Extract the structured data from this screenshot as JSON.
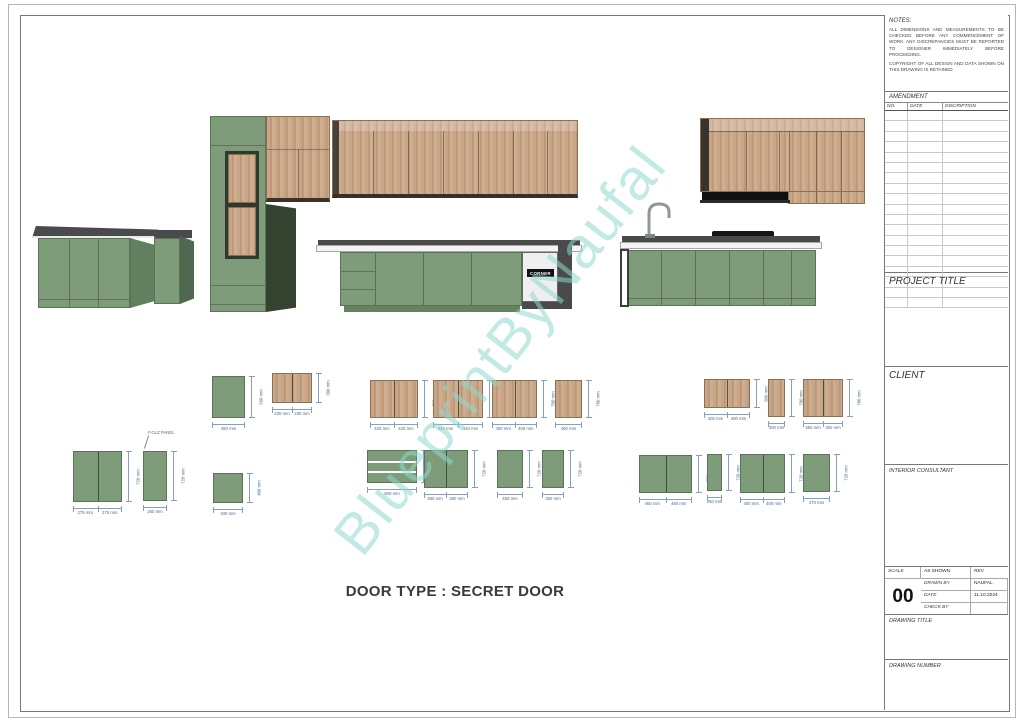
{
  "sheet": {
    "watermark": "BlueprintByNaufal",
    "caption": "DOOR TYPE : SECRET DOOR",
    "corner_label": "CORNER"
  },
  "titleblock": {
    "notes": {
      "label": "NOTES:",
      "para1": "ALL DIMENSIONS AND MEASUREMENTS TO BE CHECKED BEFORE ANY COMMENCEMENT OF WORK. ANY DISCREPANCIES MUST BE REPORTED TO DESIGNER IMMEDIATELY BEFORE PROCEEDING.",
      "para2": "COPYRIGHT OF ALL DESIGN AND DATA SHOWN ON THIS DRAWING IS RETAINED"
    },
    "amendment": {
      "label": "AMENDMENT",
      "columns": [
        "NO.",
        "DATE",
        "DISCRIPTION"
      ],
      "rows": 19
    },
    "project_title_label": "PROJECT TITLE",
    "client_label": "CLIENT",
    "interior_consultant_label": "INTERIOR CONSULTANT",
    "scale_label": "SCALE",
    "scale_value": "AS SHOWN",
    "drawn_by_label": "DRAWN BY",
    "drawn_by_value": "NAUFAL",
    "date_label": "DATE",
    "date_value": "11.10.2024",
    "check_by_label": "CHECK BY",
    "check_by_value": "",
    "rev_label": "REV",
    "rev_value": "00",
    "drawing_title_label": "DRAWING TITLE",
    "drawing_number_label": "DRAWING NUMBER"
  },
  "colors": {
    "cabinet_green": "#7e9c79",
    "cabinet_green_dark": "#62805f",
    "wood": "#c9a587",
    "counter_edge": "#4a4a4a",
    "watermark": "#8ed8ce",
    "dimension": "#85a0bc"
  },
  "details": {
    "annotation": "F.GLZ PANEL",
    "panels": [
      {
        "id": "L1",
        "x": 73,
        "y": 451,
        "w": 49,
        "h": 51,
        "mat": "green",
        "doors": 2,
        "dw": [
          "275 mm",
          "275 mm"
        ],
        "dh": "720 mm"
      },
      {
        "id": "L2",
        "x": 143,
        "y": 451,
        "w": 24,
        "h": 50,
        "mat": "green",
        "doors": 1,
        "dw": [
          "260 mm"
        ],
        "dh": "720 mm"
      },
      {
        "id": "L3",
        "x": 212,
        "y": 376,
        "w": 33,
        "h": 42,
        "mat": "green",
        "doors": 1,
        "dw": [
          "450 mm"
        ],
        "dh": "560 mm"
      },
      {
        "id": "L4",
        "x": 272,
        "y": 373,
        "w": 40,
        "h": 30,
        "mat": "wood",
        "doors": 2,
        "dw": [
          "230 mm",
          "230 mm"
        ],
        "dh": "380 mm"
      },
      {
        "id": "L5",
        "x": 213,
        "y": 473,
        "w": 30,
        "h": 30,
        "mat": "green",
        "doors": 1,
        "dw": [
          "400 mm"
        ],
        "dh": "400 mm"
      },
      {
        "id": "M1",
        "x": 370,
        "y": 380,
        "w": 48,
        "h": 38,
        "mat": "wood",
        "doors": 2,
        "dw": [
          "420 mm",
          "420 mm"
        ],
        "dh": "780 mm"
      },
      {
        "id": "M2",
        "x": 433,
        "y": 380,
        "w": 50,
        "h": 38,
        "mat": "wood",
        "doors": 2,
        "dw": [
          "440 mm",
          "440 mm"
        ],
        "dh": "780 mm"
      },
      {
        "id": "M3",
        "x": 492,
        "y": 380,
        "w": 45,
        "h": 38,
        "mat": "wood",
        "doors": 2,
        "dw": [
          "400 mm",
          "400 mm"
        ],
        "dh": "780 mm"
      },
      {
        "id": "M4",
        "x": 555,
        "y": 380,
        "w": 27,
        "h": 38,
        "mat": "wood",
        "doors": 1,
        "dw": [
          "460 mm"
        ],
        "dh": "780 mm"
      },
      {
        "id": "M5",
        "x": 367,
        "y": 450,
        "w": 50,
        "h": 33,
        "mat": "drawers",
        "doors": 1,
        "dw": [
          "900 mm"
        ],
        "dh": "600 mm"
      },
      {
        "id": "M6",
        "x": 424,
        "y": 450,
        "w": 44,
        "h": 38,
        "mat": "green",
        "doors": 2,
        "dw": [
          "380 mm",
          "380 mm"
        ],
        "dh": "720 mm"
      },
      {
        "id": "M7",
        "x": 497,
        "y": 450,
        "w": 26,
        "h": 38,
        "mat": "green",
        "doors": 1,
        "dw": [
          "450 mm"
        ],
        "dh": "720 mm"
      },
      {
        "id": "M8",
        "x": 542,
        "y": 450,
        "w": 22,
        "h": 38,
        "mat": "green",
        "doors": 1,
        "dw": [
          "350 mm"
        ],
        "dh": "720 mm"
      },
      {
        "id": "R1",
        "x": 704,
        "y": 379,
        "w": 46,
        "h": 29,
        "mat": "wood",
        "doors": 2,
        "dw": [
          "400 mm",
          "400 mm"
        ],
        "dh": "600 mm"
      },
      {
        "id": "R2",
        "x": 768,
        "y": 379,
        "w": 17,
        "h": 38,
        "mat": "wood",
        "doors": 1,
        "dw": [
          "300 mm"
        ],
        "dh": "780 mm"
      },
      {
        "id": "R3",
        "x": 803,
        "y": 379,
        "w": 40,
        "h": 38,
        "mat": "wood",
        "doors": 2,
        "dw": [
          "350 mm",
          "350 mm"
        ],
        "dh": "780 mm"
      },
      {
        "id": "R4",
        "x": 639,
        "y": 455,
        "w": 53,
        "h": 38,
        "mat": "green",
        "doors": 2,
        "dw": [
          "460 mm",
          "460 mm"
        ],
        "dh": "720 mm"
      },
      {
        "id": "R5",
        "x": 707,
        "y": 454,
        "w": 15,
        "h": 37,
        "mat": "green",
        "doors": 1,
        "dw": [
          "250 mm"
        ],
        "dh": "720 mm"
      },
      {
        "id": "R6",
        "x": 740,
        "y": 454,
        "w": 45,
        "h": 39,
        "mat": "green",
        "doors": 2,
        "dw": [
          "400 mm",
          "400 mm"
        ],
        "dh": "720 mm"
      },
      {
        "id": "R7",
        "x": 803,
        "y": 454,
        "w": 27,
        "h": 38,
        "mat": "green",
        "doors": 1,
        "dw": [
          "470 mm"
        ],
        "dh": "720 mm"
      }
    ]
  }
}
